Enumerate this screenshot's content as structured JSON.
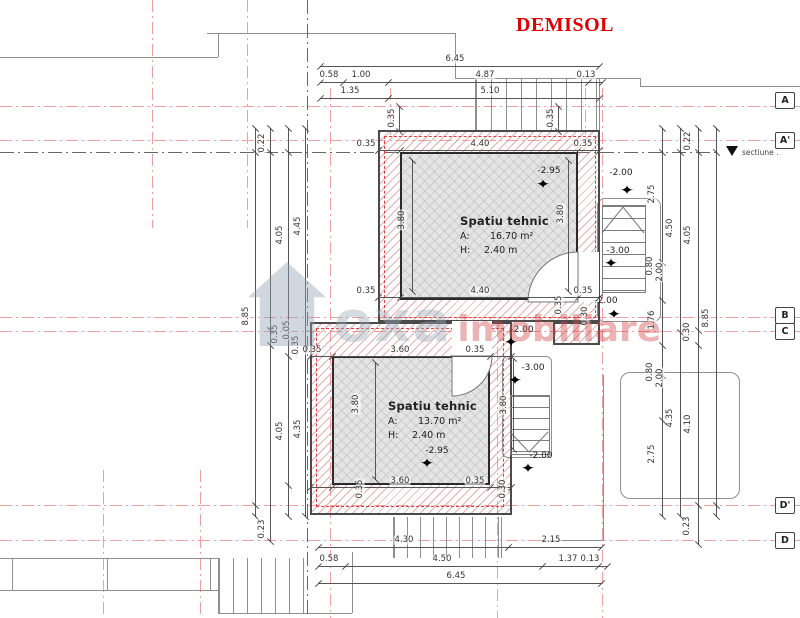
{
  "title": "DEMISOL",
  "section_marker": {
    "label": "sectiune ."
  },
  "watermark": {
    "brand": "oxa",
    "suffix": "imobiliare"
  },
  "symbols": {
    "elevation_star": "✦"
  },
  "grid_labels": [
    {
      "t": "A",
      "x": 775,
      "y": 92
    },
    {
      "t": "A'",
      "x": 775,
      "y": 132
    },
    {
      "t": "B",
      "x": 775,
      "y": 307
    },
    {
      "t": "C",
      "x": 775,
      "y": 323
    },
    {
      "t": "D'",
      "x": 775,
      "y": 497
    },
    {
      "t": "D",
      "x": 775,
      "y": 532
    }
  ],
  "rooms": [
    {
      "name": "Spatiu tehnic",
      "area_key": "A:",
      "area_value": "16.70 m²",
      "height_key": "H:",
      "height_value": "2.40 m"
    },
    {
      "name": "Spatiu tehnic",
      "area_key": "A:",
      "area_value": "13.70 m²",
      "height_key": "H:",
      "height_value": "2.40 m"
    }
  ],
  "elevation_markers": [
    {
      "label": "-2.95",
      "x": 549,
      "y": 171,
      "sx": 543,
      "sy": 185
    },
    {
      "label": "-2.00",
      "x": 621,
      "y": 173,
      "sx": 627,
      "sy": 191
    },
    {
      "label": "-3.00",
      "x": 618,
      "y": 251,
      "sx": 611,
      "sy": 264
    },
    {
      "label": "-2.00",
      "x": 606,
      "y": 301,
      "sx": 614,
      "sy": 315
    },
    {
      "label": "-2.00",
      "x": 522,
      "y": 330,
      "sx": 511,
      "sy": 343
    },
    {
      "label": "-3.00",
      "x": 533,
      "y": 368,
      "sx": 515,
      "sy": 381
    },
    {
      "label": "-2.95",
      "x": 437,
      "y": 451,
      "sx": 427,
      "sy": 464
    },
    {
      "label": "-2.00",
      "x": 541,
      "y": 456,
      "sx": 528,
      "sy": 469
    }
  ],
  "dimension_labels": [
    {
      "t": "6.45",
      "x": 455,
      "y": 59
    },
    {
      "t": "0.58",
      "x": 329,
      "y": 75
    },
    {
      "t": "1.00",
      "x": 361,
      "y": 75
    },
    {
      "t": "4.87",
      "x": 485,
      "y": 75
    },
    {
      "t": "0.13",
      "x": 586,
      "y": 75
    },
    {
      "t": "1.35",
      "x": 350,
      "y": 91
    },
    {
      "t": "5.10",
      "x": 490,
      "y": 91
    },
    {
      "t": "0.35",
      "x": 392,
      "y": 118,
      "r": 1
    },
    {
      "t": "0.35",
      "x": 551,
      "y": 118,
      "r": 1
    },
    {
      "t": "0.35",
      "x": 366,
      "y": 144
    },
    {
      "t": "4.40",
      "x": 480,
      "y": 144
    },
    {
      "t": "0.35",
      "x": 583,
      "y": 144
    },
    {
      "t": "3.80",
      "x": 402,
      "y": 220,
      "r": 1
    },
    {
      "t": "3.80",
      "x": 561,
      "y": 214,
      "r": 1
    },
    {
      "t": "0.35",
      "x": 366,
      "y": 291
    },
    {
      "t": "4.40",
      "x": 480,
      "y": 291
    },
    {
      "t": "0.35",
      "x": 583,
      "y": 291
    },
    {
      "t": "0.35",
      "x": 559,
      "y": 305,
      "r": 1
    },
    {
      "t": "0.30",
      "x": 585,
      "y": 316,
      "r": 1
    },
    {
      "t": "0.35",
      "x": 312,
      "y": 350
    },
    {
      "t": "3.60",
      "x": 400,
      "y": 350
    },
    {
      "t": "0.35",
      "x": 475,
      "y": 350
    },
    {
      "t": "3.80",
      "x": 356,
      "y": 404,
      "r": 1
    },
    {
      "t": "3.60",
      "x": 400,
      "y": 481
    },
    {
      "t": "0.35",
      "x": 475,
      "y": 481
    },
    {
      "t": "0.35",
      "x": 360,
      "y": 489,
      "r": 1
    },
    {
      "t": "0.30",
      "x": 503,
      "y": 489,
      "r": 1
    },
    {
      "t": "4.30",
      "x": 404,
      "y": 540
    },
    {
      "t": "2.15",
      "x": 551,
      "y": 540
    },
    {
      "t": "0.58",
      "x": 329,
      "y": 559
    },
    {
      "t": "4.50",
      "x": 442,
      "y": 559
    },
    {
      "t": "1.37",
      "x": 568,
      "y": 559
    },
    {
      "t": "0.13",
      "x": 590,
      "y": 559
    },
    {
      "t": "6.45",
      "x": 456,
      "y": 576
    },
    {
      "t": "8.85",
      "x": 246,
      "y": 316,
      "r": 1
    },
    {
      "t": "0.22",
      "x": 262,
      "y": 143,
      "r": 1
    },
    {
      "t": "0.23",
      "x": 262,
      "y": 529,
      "r": 1
    },
    {
      "t": "4.05",
      "x": 280,
      "y": 235,
      "r": 1
    },
    {
      "t": "4.05",
      "x": 280,
      "y": 431,
      "r": 1
    },
    {
      "t": "4.45",
      "x": 298,
      "y": 226,
      "r": 1
    },
    {
      "t": "4.35",
      "x": 298,
      "y": 429,
      "r": 1
    },
    {
      "t": "0.35",
      "x": 275,
      "y": 334,
      "r": 1
    },
    {
      "t": "0.05",
      "x": 287,
      "y": 330,
      "r": 1
    },
    {
      "t": "0.35",
      "x": 296,
      "y": 345,
      "r": 1
    },
    {
      "t": "2.75",
      "x": 652,
      "y": 194,
      "r": 1
    },
    {
      "t": "0.80",
      "x": 650,
      "y": 266,
      "r": 1
    },
    {
      "t": "2.00",
      "x": 660,
      "y": 272,
      "r": 1
    },
    {
      "t": "1.76",
      "x": 652,
      "y": 320,
      "r": 1
    },
    {
      "t": "0.80",
      "x": 650,
      "y": 372,
      "r": 1
    },
    {
      "t": "2.00",
      "x": 660,
      "y": 378,
      "r": 1
    },
    {
      "t": "2.75",
      "x": 652,
      "y": 454,
      "r": 1
    },
    {
      "t": "4.50",
      "x": 670,
      "y": 228,
      "r": 1
    },
    {
      "t": "4.35",
      "x": 670,
      "y": 418,
      "r": 1
    },
    {
      "t": "0.22",
      "x": 688,
      "y": 141,
      "r": 1
    },
    {
      "t": "4.05",
      "x": 688,
      "y": 235,
      "r": 1
    },
    {
      "t": "0.30",
      "x": 687,
      "y": 332,
      "r": 1
    },
    {
      "t": "4.10",
      "x": 688,
      "y": 424,
      "r": 1
    },
    {
      "t": "0.23",
      "x": 687,
      "y": 526,
      "r": 1
    },
    {
      "t": "8.85",
      "x": 706,
      "y": 318,
      "r": 1
    },
    {
      "t": "3.80",
      "x": 504,
      "y": 405,
      "r": 1
    }
  ]
}
